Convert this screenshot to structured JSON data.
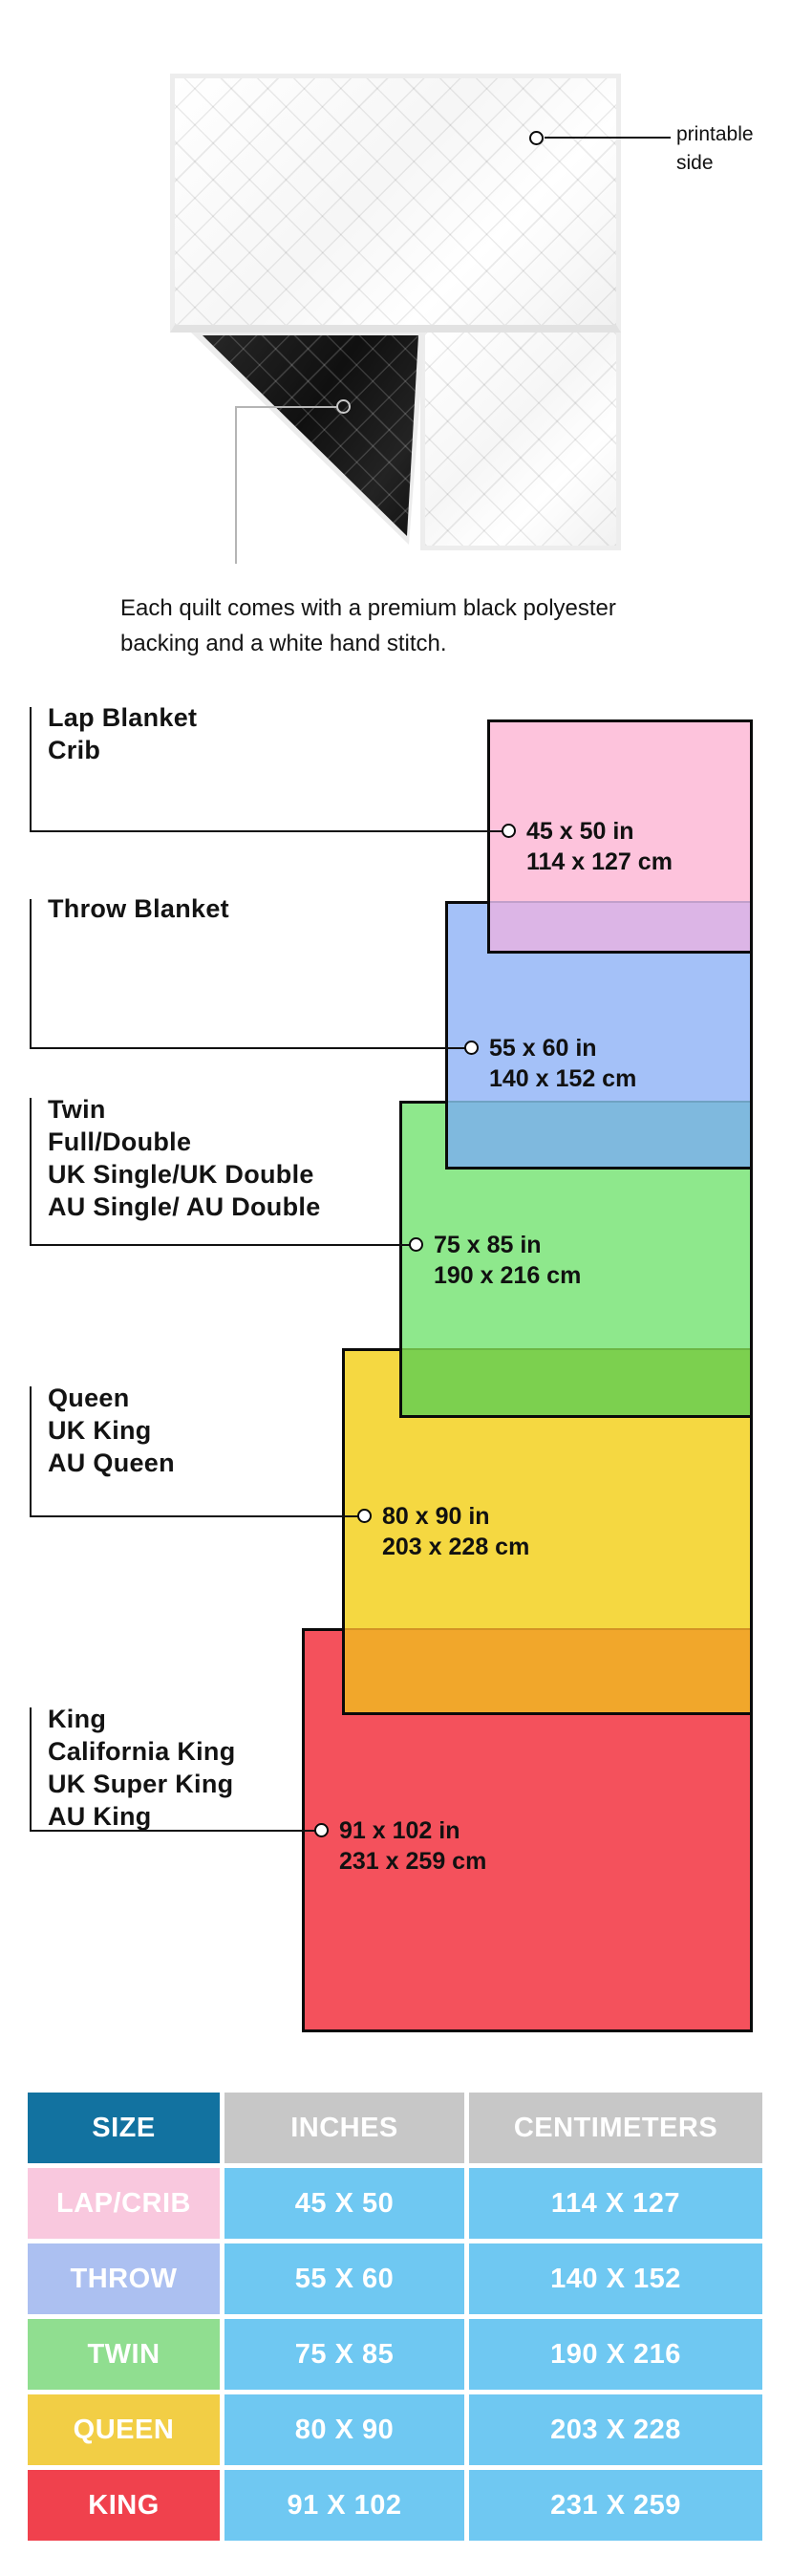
{
  "quilt": {
    "printable_label_lines": [
      "printable",
      "side"
    ],
    "caption_lines": [
      "Each quilt comes with a premium black polyester",
      "backing and a white hand stitch."
    ]
  },
  "diagram": {
    "border_color": "#0a0a0a",
    "blankets": [
      {
        "id": "lap",
        "names": [
          "Lap Blanket",
          "Crib"
        ],
        "inches": "45 x 50 in",
        "cm": "114 x 127 cm",
        "color": "#FDC3DC",
        "overlap_color": "#DCB5E6"
      },
      {
        "id": "throw",
        "names": [
          "Throw Blanket"
        ],
        "inches": "55 x 60 in",
        "cm": "140 x 152 cm",
        "color": "#A4C1F8",
        "overlap_color": "#7FB9DE"
      },
      {
        "id": "twin",
        "names": [
          "Twin",
          "Full/Double",
          "UK Single/UK Double",
          "AU Single/ AU Double"
        ],
        "inches": "75 x 85 in",
        "cm": "190 x 216 cm",
        "color": "#8EE88C",
        "overlap_color": "#7CD04F"
      },
      {
        "id": "queen",
        "names": [
          "Queen",
          "UK King",
          "AU Queen"
        ],
        "inches": "80 x 90 in",
        "cm": "203 x 228 cm",
        "color": "#F5D841",
        "overlap_color": "#F1A72B"
      },
      {
        "id": "king",
        "names": [
          "King",
          "California King",
          "UK Super King",
          "AU King"
        ],
        "inches": "91 x 102 in",
        "cm": "231 x 259 cm",
        "color": "#F4515C",
        "overlap_color": ""
      }
    ]
  },
  "table": {
    "headers": [
      {
        "label": "SIZE",
        "bg": "#1272A0"
      },
      {
        "label": "INCHES",
        "bg": "#C7C7C7"
      },
      {
        "label": "CENTIMETERS",
        "bg": "#C7C7C7"
      }
    ],
    "data_cell_bg": "#6FC8F2",
    "rows": [
      {
        "size": "LAP/CRIB",
        "inches": "45 X 50",
        "cm": "114 X 127",
        "color": "#F9C8DE"
      },
      {
        "size": "THROW",
        "inches": "55 X 60",
        "cm": "140 X 152",
        "color": "#ACC0F1"
      },
      {
        "size": "TWIN",
        "inches": "75 X 85",
        "cm": "190 X 216",
        "color": "#90DE90"
      },
      {
        "size": "QUEEN",
        "inches": "80 X 90",
        "cm": "203 X 228",
        "color": "#F2CE45"
      },
      {
        "size": "KING",
        "inches": "91 X 102",
        "cm": "231 X 259",
        "color": "#F0414D"
      }
    ]
  }
}
